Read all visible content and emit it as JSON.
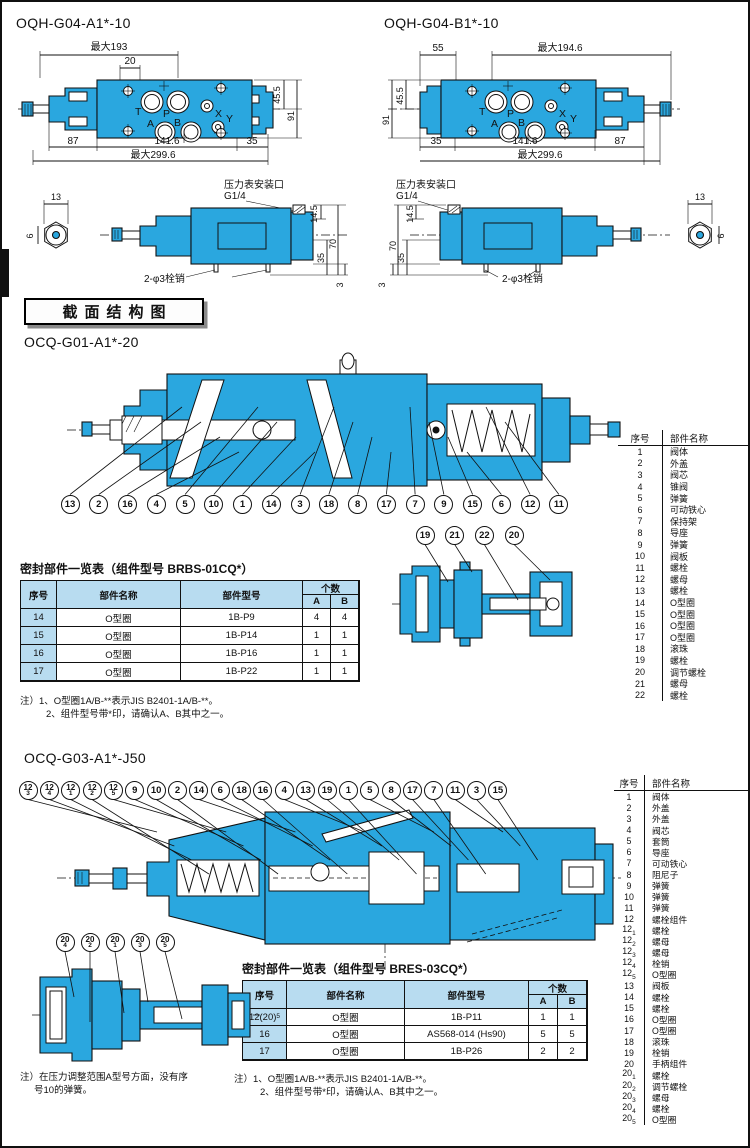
{
  "colors": {
    "valve_blue": "#2aa7df",
    "table_header_blue": "#b8dcf0",
    "line_black": "#111111"
  },
  "section_header": "截面结构图",
  "top_left": {
    "title": "OQH-G04-A1*-10",
    "dims": {
      "top_max": "最大193",
      "top_offset": "20",
      "right_inner": "45.5",
      "right_outer": "91",
      "bot_left": "87",
      "bot_mid": "141.6",
      "bot_right": "35",
      "bot_max": "最大299.6"
    },
    "ports": {
      "t": "T",
      "p": "P",
      "x": "X",
      "a": "A",
      "b": "B",
      "y": "Y"
    }
  },
  "top_right": {
    "title": "OQH-G04-B1*-10",
    "dims": {
      "top_left": "55",
      "top_max": "最大194.6",
      "left_inner": "45.5",
      "left_outer": "91",
      "bot_left": "35",
      "bot_mid": "141.6",
      "bot_right": "87",
      "bot_max": "最大299.6"
    },
    "ports": {
      "t": "T",
      "p": "P",
      "x": "X",
      "a": "A",
      "b": "B",
      "y": "Y"
    }
  },
  "side_left": {
    "hex_width": "13",
    "hex_across": "6",
    "gauge_line1": "压力表安装口",
    "gauge_line2": "G1/4",
    "dim_port": "14.5",
    "dim_total": "70",
    "dim_lower": "35",
    "dim_base": "3",
    "pin_label": "2-φ3栓销"
  },
  "side_right": {
    "hex_width": "13",
    "hex_across": "6",
    "gauge_line1": "压力表安装口",
    "gauge_line2": "G1/4",
    "dim_port": "14.5",
    "dim_total": "70",
    "dim_lower": "35",
    "dim_base": "3",
    "pin_label": "2-φ3栓销"
  },
  "section1": {
    "model": "OCQ-G01-A1*-20",
    "callouts_main": [
      "13",
      "2",
      "16",
      "4",
      "5",
      "10",
      "1",
      "14",
      "3",
      "18",
      "8",
      "17",
      "7",
      "9",
      "15",
      "6",
      "12",
      "11"
    ],
    "callouts_sub": [
      "19",
      "21",
      "22",
      "20"
    ],
    "parts_table": {
      "headers": [
        "序号",
        "部件名称"
      ],
      "rows": [
        {
          "no": "1",
          "name": "阀体"
        },
        {
          "no": "2",
          "name": "外盖"
        },
        {
          "no": "3",
          "name": "阀芯"
        },
        {
          "no": "4",
          "name": "锥阀"
        },
        {
          "no": "5",
          "name": "弹簧"
        },
        {
          "no": "6",
          "name": "可动铁心"
        },
        {
          "no": "7",
          "name": "保持架"
        },
        {
          "no": "8",
          "name": "导座"
        },
        {
          "no": "9",
          "name": "弹簧"
        },
        {
          "no": "10",
          "name": "阀板"
        },
        {
          "no": "11",
          "name": "螺栓"
        },
        {
          "no": "12",
          "name": "螺母"
        },
        {
          "no": "13",
          "name": "螺栓"
        },
        {
          "no": "14",
          "name": "O型圈"
        },
        {
          "no": "15",
          "name": "O型圈"
        },
        {
          "no": "16",
          "name": "O型圈"
        },
        {
          "no": "17",
          "name": "O型圈"
        },
        {
          "no": "18",
          "name": "滚珠"
        },
        {
          "no": "19",
          "name": "螺栓"
        },
        {
          "no": "20",
          "name": "调节螺栓"
        },
        {
          "no": "21",
          "name": "螺母"
        },
        {
          "no": "22",
          "name": "螺栓"
        }
      ]
    },
    "seal_table": {
      "title": "密封部件一览表（组件型号 BRBS-01CQ*）",
      "col_no": "序号",
      "col_name": "部件名称",
      "col_model": "部件型号",
      "col_qty": "个数",
      "col_a": "A",
      "col_b": "B",
      "rows": [
        {
          "no": "14",
          "name": "O型圈",
          "model": "1B-P9",
          "a": "4",
          "b": "4"
        },
        {
          "no": "15",
          "name": "O型圈",
          "model": "1B-P14",
          "a": "1",
          "b": "1"
        },
        {
          "no": "16",
          "name": "O型圈",
          "model": "1B-P16",
          "a": "1",
          "b": "1"
        },
        {
          "no": "17",
          "name": "O型圈",
          "model": "1B-P22",
          "a": "1",
          "b": "1"
        }
      ]
    },
    "notes": [
      "注）1、O型圈1A/B-**表示JIS B2401-1A/B-**。",
      "2、组件型号带*印，请确认A、B其中之一。"
    ]
  },
  "section2": {
    "model": "OCQ-G03-A1*-J50",
    "callouts_main": [
      {
        "t": "12",
        "s": "3"
      },
      {
        "t": "12",
        "s": "4"
      },
      {
        "t": "12",
        "s": "1"
      },
      {
        "t": "12",
        "s": "2"
      },
      {
        "t": "12",
        "s": "5"
      },
      {
        "t": "9"
      },
      {
        "t": "10"
      },
      {
        "t": "2"
      },
      {
        "t": "14"
      },
      {
        "t": "6"
      },
      {
        "t": "18"
      },
      {
        "t": "16"
      },
      {
        "t": "4"
      },
      {
        "t": "13"
      },
      {
        "t": "19"
      },
      {
        "t": "1"
      },
      {
        "t": "5"
      },
      {
        "t": "8"
      },
      {
        "t": "17"
      },
      {
        "t": "7"
      },
      {
        "t": "11"
      },
      {
        "t": "3"
      },
      {
        "t": "15"
      }
    ],
    "callouts_sub": [
      {
        "t": "20",
        "s": "4"
      },
      {
        "t": "20",
        "s": "2"
      },
      {
        "t": "20",
        "s": "1"
      },
      {
        "t": "20",
        "s": "3"
      },
      {
        "t": "20",
        "s": "5"
      }
    ],
    "parts_table": {
      "headers": [
        "序号",
        "部件名称"
      ],
      "rows": [
        {
          "no": "1",
          "name": "阀体"
        },
        {
          "no": "2",
          "name": "外盖"
        },
        {
          "no": "3",
          "name": "外盖"
        },
        {
          "no": "4",
          "name": "阀芯"
        },
        {
          "no": "5",
          "name": "套筒"
        },
        {
          "no": "6",
          "name": "导座"
        },
        {
          "no": "7",
          "name": "可动铁心"
        },
        {
          "no": "8",
          "name": "阻尼子"
        },
        {
          "no": "9",
          "name": "弹簧"
        },
        {
          "no": "10",
          "name": "弹簧"
        },
        {
          "no": "11",
          "name": "弹簧"
        },
        {
          "no": "12",
          "name": "螺栓组件"
        },
        {
          "no": "12",
          "sub": "1",
          "name": "螺栓"
        },
        {
          "no": "12",
          "sub": "2",
          "name": "螺母"
        },
        {
          "no": "12",
          "sub": "3",
          "name": "螺母"
        },
        {
          "no": "12",
          "sub": "4",
          "name": "栓销"
        },
        {
          "no": "12",
          "sub": "5",
          "name": "O型圈"
        },
        {
          "no": "13",
          "name": "阀板"
        },
        {
          "no": "14",
          "name": "螺栓"
        },
        {
          "no": "15",
          "name": "螺栓"
        },
        {
          "no": "16",
          "name": "O型圈"
        },
        {
          "no": "17",
          "name": "O型圈"
        },
        {
          "no": "18",
          "name": "滚珠"
        },
        {
          "no": "19",
          "name": "栓销"
        },
        {
          "no": "20",
          "name": "手柄组件"
        },
        {
          "no": "20",
          "sub": "1",
          "name": "螺栓"
        },
        {
          "no": "20",
          "sub": "2",
          "name": "调节螺栓"
        },
        {
          "no": "20",
          "sub": "3",
          "name": "螺母"
        },
        {
          "no": "20",
          "sub": "4",
          "name": "螺栓"
        },
        {
          "no": "20",
          "sub": "5",
          "name": "O型圈"
        }
      ]
    },
    "seal_table": {
      "title": "密封部件一览表（组件型号 BRES-03CQ*）",
      "col_no": "序号",
      "col_name": "部件名称",
      "col_model": "部件型号",
      "col_qty": "个数",
      "col_a": "A",
      "col_b": "B",
      "rows": [
        {
          "no": "12(20)",
          "sub": "5",
          "name": "O型圈",
          "model": "1B-P11",
          "a": "1",
          "b": "1"
        },
        {
          "no": "16",
          "name": "O型圈",
          "model": "AS568-014 (Hs90)",
          "a": "5",
          "b": "5"
        },
        {
          "no": "17",
          "name": "O型圈",
          "model": "1B-P26",
          "a": "2",
          "b": "2"
        }
      ]
    },
    "notes": [
      "注）1、O型圈1A/B-**表示JIS B2401-1A/B-**。",
      "2、组件型号带*印，请确认A、B其中之一。"
    ],
    "extra_note": [
      "注）在压力调整范围A型号方面，没有序",
      "号10的弹簧。"
    ]
  }
}
